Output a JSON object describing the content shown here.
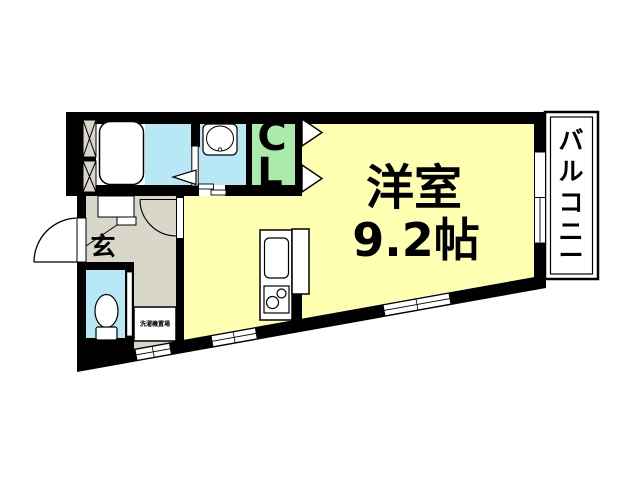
{
  "floorplan": {
    "main_room": {
      "name": "洋室",
      "size": "9.2帖"
    },
    "closet": {
      "label": "CL",
      "chars": [
        "C",
        "L"
      ]
    },
    "balcony": {
      "label": "バルコニー",
      "chars": [
        "バ",
        "ル",
        "コ",
        "ニ",
        "ー"
      ]
    },
    "entrance": {
      "label": "玄"
    },
    "laundry": {
      "label": "洗濯機置場"
    },
    "colors": {
      "room_yellow": "#FFFFB2",
      "water_blue": "#B8E7F5",
      "closet_green": "#AAEAAA",
      "hall_gray": "#D9D6CA",
      "wall_black": "#000000",
      "background": "#FFFFFF"
    }
  }
}
